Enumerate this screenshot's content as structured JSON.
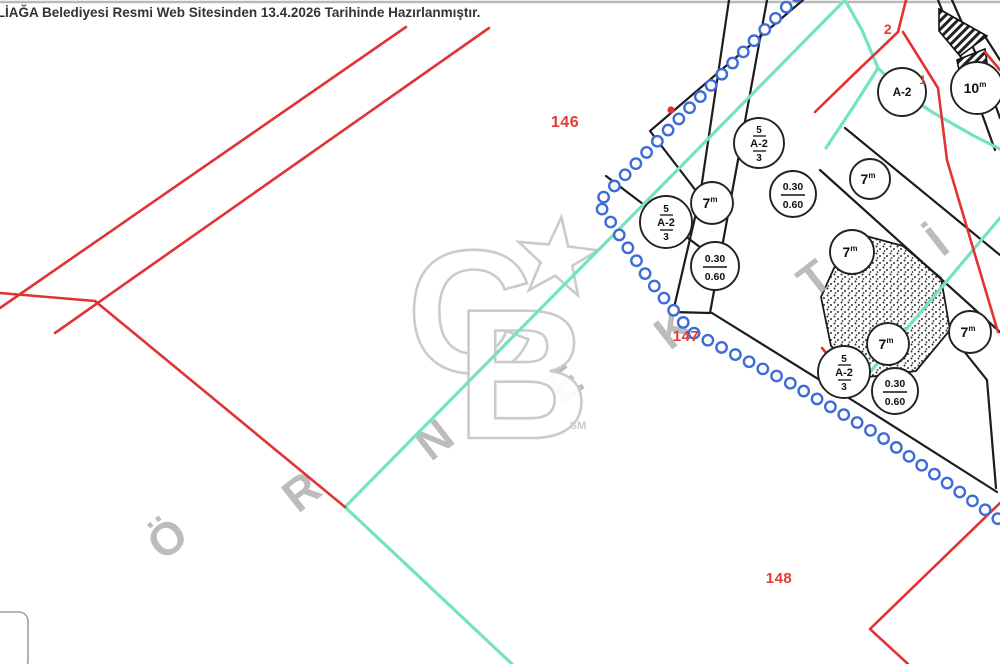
{
  "header": {
    "text": "ALİAĞA Belediyesi Resmi Web Sitesinden 13.4.2026 Tarihinde Hazırlanmıştır."
  },
  "map": {
    "colors": {
      "red": "#e23333",
      "red_label": "#e03b35",
      "teal": "#74e3c0",
      "chain_blue": "#3e6cd6",
      "black": "#1c1c1c",
      "gray_watermark": "#b5b5b5",
      "logo_gray": "#c9c9c9"
    },
    "parcel_labels": [
      {
        "text": "146",
        "x": 565,
        "y": 127,
        "size": 16
      },
      {
        "text": "147",
        "x": 686,
        "y": 341,
        "size": 15
      },
      {
        "text": "148",
        "x": 779,
        "y": 583,
        "size": 15
      },
      {
        "text": "2",
        "x": 888,
        "y": 34,
        "size": 14
      },
      {
        "text": "1",
        "x": 923,
        "y": 84,
        "size": 12
      }
    ],
    "zone_circles": [
      {
        "x": 759,
        "y": 143,
        "r": 25,
        "type": "stack",
        "l1": "5",
        "l2": "A-2",
        "l3": "3"
      },
      {
        "x": 793,
        "y": 194,
        "r": 23,
        "type": "ratio",
        "l1": "0.30",
        "l2": "0.60"
      },
      {
        "x": 870,
        "y": 179,
        "r": 20,
        "type": "road",
        "l1": "7",
        "sup": "m"
      },
      {
        "x": 666,
        "y": 222,
        "r": 26,
        "type": "stack",
        "l1": "5",
        "l2": "A-2",
        "l3": "3"
      },
      {
        "x": 712,
        "y": 203,
        "r": 21,
        "type": "road",
        "l1": "7",
        "sup": "m"
      },
      {
        "x": 715,
        "y": 266,
        "r": 24,
        "type": "ratio",
        "l1": "0.30",
        "l2": "0.60"
      },
      {
        "x": 852,
        "y": 252,
        "r": 22,
        "type": "road",
        "l1": "7",
        "sup": "m"
      },
      {
        "x": 970,
        "y": 332,
        "r": 21,
        "type": "road",
        "l1": "7",
        "sup": "m"
      },
      {
        "x": 888,
        "y": 344,
        "r": 21,
        "type": "road",
        "l1": "7",
        "sup": "m"
      },
      {
        "x": 844,
        "y": 372,
        "r": 26,
        "type": "stack",
        "l1": "5",
        "l2": "A-2",
        "l3": "3"
      },
      {
        "x": 895,
        "y": 391,
        "r": 23,
        "type": "ratio",
        "l1": "0.30",
        "l2": "0.60"
      },
      {
        "x": 902,
        "y": 92,
        "r": 24,
        "type": "a2",
        "l1": "A-2"
      },
      {
        "x": 977,
        "y": 88,
        "r": 26,
        "type": "road",
        "l1": "10",
        "sup": "m"
      }
    ],
    "watermark": {
      "word": "ÖRNEKTİR",
      "rotation": -38,
      "letters": [
        {
          "ch": "Ö",
          "x": 177,
          "y": 551
        },
        {
          "ch": "R",
          "x": 311,
          "y": 504
        },
        {
          "ch": "N",
          "x": 444,
          "y": 452
        },
        {
          "ch": "E",
          "x": 574,
          "y": 396
        },
        {
          "ch": "K",
          "x": 683,
          "y": 341
        },
        {
          "ch": "T",
          "x": 824,
          "y": 291
        },
        {
          "ch": "İ",
          "x": 947,
          "y": 254
        }
      ],
      "logo": {
        "c": "C",
        "b": "B",
        "sm": "SM"
      }
    },
    "park": {
      "points": [
        [
          866,
          236
        ],
        [
          903,
          246
        ],
        [
          941,
          278
        ],
        [
          950,
          330
        ],
        [
          916,
          371
        ],
        [
          868,
          377
        ],
        [
          831,
          346
        ],
        [
          821,
          297
        ],
        [
          839,
          257
        ]
      ]
    },
    "boundary_chain": {
      "points": [
        [
          797,
          -4
        ],
        [
          598,
          203
        ],
        [
          648,
          278
        ],
        [
          690,
          331
        ],
        [
          790,
          383
        ],
        [
          880,
          436
        ],
        [
          1004,
          523
        ]
      ],
      "spacing": 15.5,
      "radius": 5.2,
      "red_dot": [
        671,
        110
      ]
    },
    "black_lines": [
      [
        [
          803,
          0
        ],
        [
          650,
          131
        ],
        [
          700,
          196
        ]
      ],
      [
        [
          729,
          0
        ],
        [
          700,
          196
        ],
        [
          673,
          312
        ]
      ],
      [
        [
          767,
          0
        ],
        [
          738,
          160
        ],
        [
          710,
          313
        ]
      ],
      [
        [
          606,
          176
        ],
        [
          717,
          260
        ]
      ],
      [
        [
          845,
          128
        ],
        [
          1000,
          255
        ]
      ],
      [
        [
          820,
          170
        ],
        [
          1000,
          332
        ]
      ],
      [
        [
          712,
          313
        ],
        [
          860,
          405
        ],
        [
          997,
          492
        ]
      ],
      [
        [
          955,
          340
        ],
        [
          987,
          380
        ],
        [
          996,
          488
        ]
      ],
      [
        [
          938,
          0
        ],
        [
          968,
          75
        ],
        [
          995,
          150
        ]
      ],
      [
        [
          952,
          0
        ],
        [
          983,
          70
        ],
        [
          1000,
          118
        ]
      ],
      [
        [
          986,
          38
        ],
        [
          1000,
          60
        ]
      ],
      [
        [
          673,
          312
        ],
        [
          710,
          313
        ]
      ]
    ],
    "teal_lines": [
      [
        [
          345,
          507
        ],
        [
          843,
          2
        ]
      ],
      [
        [
          345,
          507
        ],
        [
          512,
          664
        ]
      ],
      [
        [
          845,
          0
        ],
        [
          862,
          30
        ],
        [
          878,
          68
        ],
        [
          905,
          94
        ],
        [
          932,
          112
        ],
        [
          974,
          136
        ],
        [
          1000,
          149
        ]
      ],
      [
        [
          878,
          68
        ],
        [
          854,
          106
        ],
        [
          826,
          148
        ]
      ],
      [
        [
          1000,
          218
        ],
        [
          850,
          396
        ]
      ]
    ],
    "red_lines": [
      [
        [
          406,
          27
        ],
        [
          0,
          308
        ]
      ],
      [
        [
          489,
          28
        ],
        [
          55,
          333
        ]
      ],
      [
        [
          0,
          293
        ],
        [
          95,
          301
        ]
      ],
      [
        [
          95,
          301
        ],
        [
          345,
          507
        ]
      ],
      [
        [
          906,
          0
        ],
        [
          898,
          32
        ],
        [
          852,
          76
        ],
        [
          815,
          112
        ]
      ],
      [
        [
          903,
          32
        ],
        [
          938,
          88
        ],
        [
          947,
          160
        ],
        [
          973,
          248
        ],
        [
          998,
          332
        ]
      ],
      [
        [
          985,
          52
        ],
        [
          1000,
          70
        ]
      ],
      [
        [
          1000,
          503
        ],
        [
          870,
          629
        ],
        [
          908,
          664
        ]
      ],
      [
        [
          822,
          348
        ],
        [
          852,
          384
        ]
      ]
    ]
  }
}
